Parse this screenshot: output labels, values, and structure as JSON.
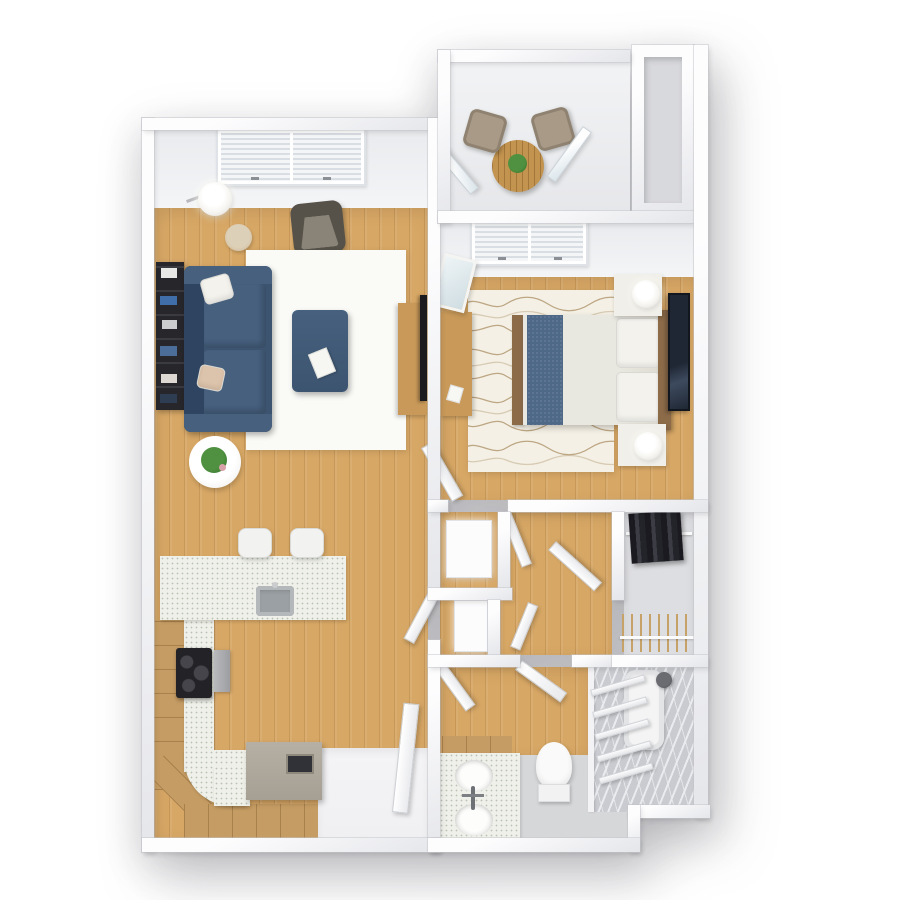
{
  "scene": {
    "type": "3d_floor_plan_render",
    "view": "top_down_birds_eye",
    "unit": "one-bedroom apartment",
    "visible_text": "none"
  },
  "palette": {
    "background": "#ffffff",
    "wall_side": "#e5e6ea",
    "wall_face": "#e9ebee",
    "wood": "#d7a765",
    "rug_living": "#fafaf7",
    "rug_bed": "#f4f0e5",
    "rug_wave": "#b39a72",
    "sofa": "#3c546f",
    "sofa_dark": "#2f4460",
    "sofa_light": "#46607e",
    "pillow_white": "#f3f2ed",
    "pillow_tan": "#dcc3ab",
    "armchair_frame": "#56524a",
    "armchair_seat": "#8a8478",
    "table_glass": "#c9b392",
    "wood_furniture": "#c89959",
    "tv_black": "#1b1b1f",
    "bookshelf_dark": "#26262b",
    "duvet": "#e9e8e0",
    "bed_runner": "#4e6888",
    "headboard": "#8c6b49",
    "nightstand": "#f0efe9",
    "lamp": "#f6f5f1",
    "art": "#1f2734",
    "balcony_floor": "#e6e7ea",
    "bistro_wood": "#c3944f",
    "chair_taupe": "#a89a86",
    "plant": "#4f9140",
    "plant_dark": "#2e6b28",
    "counter": "#eff0e9",
    "cabinet": "#c59c63",
    "island": "#a69f94",
    "island_dark": "#313138",
    "cooktop": "#232327",
    "steel": "#9aa0a4",
    "white_goods": "#fcfcfd",
    "closet_floor": "#dddee1",
    "clothes_dark": "#1a1a20",
    "shoe_tan": "#c7a268",
    "bath_floor": "#d6d7d9",
    "marble": "#c9cbd0",
    "marble_vein": "#eaebef",
    "mat_tan": "#c49a5e",
    "toilet": "#fafafa",
    "entry_floor": "#f0f0f2",
    "glass": "#d9e4ea"
  },
  "rooms": [
    {
      "id": "living-room",
      "furniture": [
        "double-window-blinds",
        "navy-sectional-sofa",
        "throw-pillows",
        "navy-ottoman",
        "white-area-rug",
        "gray-armchair",
        "floor-lamp",
        "glass-side-table",
        "bookshelf",
        "coffee-table-with-plant",
        "tv-console",
        "flat-tv"
      ]
    },
    {
      "id": "balcony-dining-nook",
      "furniture": [
        "round-bistro-table",
        "potted-plant",
        "two-taupe-chairs",
        "glass-doors"
      ]
    },
    {
      "id": "utility-chase",
      "furniture": []
    },
    {
      "id": "bedroom",
      "furniture": [
        "double-window-blinds",
        "queen-bed-blue-runner",
        "two-pillows",
        "headboard",
        "two-nightstands",
        "two-table-lamps",
        "wavy-area-rug",
        "wall-art",
        "desk",
        "leaning-mirror",
        "open-door"
      ]
    },
    {
      "id": "hallway-laundry",
      "furniture": [
        "washer-closet",
        "dryer-closet",
        "open-doors"
      ]
    },
    {
      "id": "walk-in-closet",
      "furniture": [
        "hanging-clothes-rod",
        "shoe-rack",
        "open-door"
      ]
    },
    {
      "id": "bathroom",
      "furniture": [
        "double-sink-vanity",
        "faucet",
        "toilet",
        "bathtub",
        "marble-shower-surround",
        "shower-head",
        "towel-ladder",
        "bath-mat",
        "open-door"
      ]
    },
    {
      "id": "kitchen",
      "furniture": [
        "peninsula-counter",
        "kitchen-sink",
        "two-bar-stools",
        "l-shaped-counter",
        "wood-cabinets",
        "cooktop",
        "wall-oven",
        "gray-island-bench",
        "entry-landing",
        "entry-door"
      ]
    }
  ]
}
